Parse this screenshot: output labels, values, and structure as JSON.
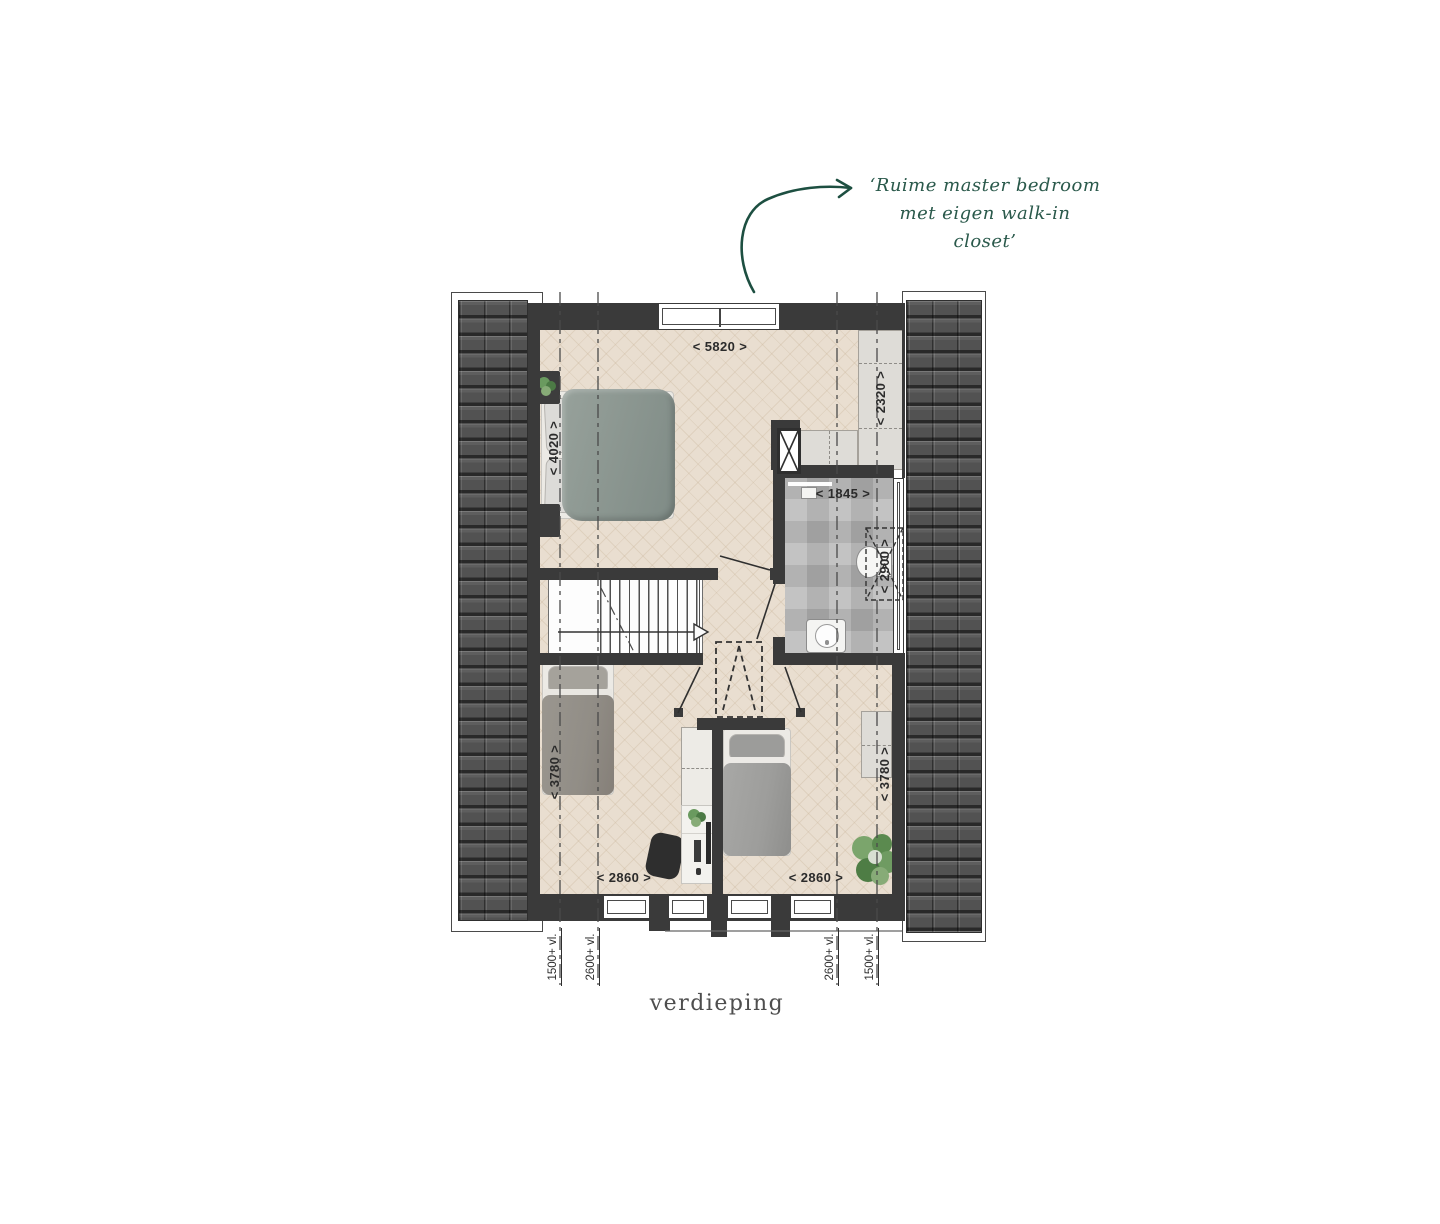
{
  "title": "verdieping",
  "annotation": {
    "line1": "‘Ruime master bedroom",
    "line2": "met eigen walk-in",
    "line3": "closet’"
  },
  "dimensions": {
    "master_width": "< 5820 >",
    "master_depth": "< 4020 >",
    "closet_depth": "< 2320 >",
    "bathroom_width": "< 1845 >",
    "bathroom_depth": "< 2900 >",
    "bedroom_left_depth": "< 3780 >",
    "bedroom_left_width": "< 2860 >",
    "bedroom_right_width": "< 2860 >",
    "bedroom_right_depth": "< 3780 >"
  },
  "level_markers": {
    "left_outer": "1500+ vl.",
    "left_inner": "2600+ vl.",
    "right_inner": "2600+ vl.",
    "right_outer": "1500+ vl."
  },
  "colors": {
    "floor": "#e9ded0",
    "wall": "#3a3a3a",
    "roof": "#525252",
    "bath_floor": "#b7b7b7",
    "cabinet": "#dedcd7",
    "duvet_master": "#8c9791",
    "duvet_single": "#918d86",
    "annotation_green": "#2a594b",
    "dim_text": "#2b2b2b",
    "title_text": "#4e4e4e"
  }
}
